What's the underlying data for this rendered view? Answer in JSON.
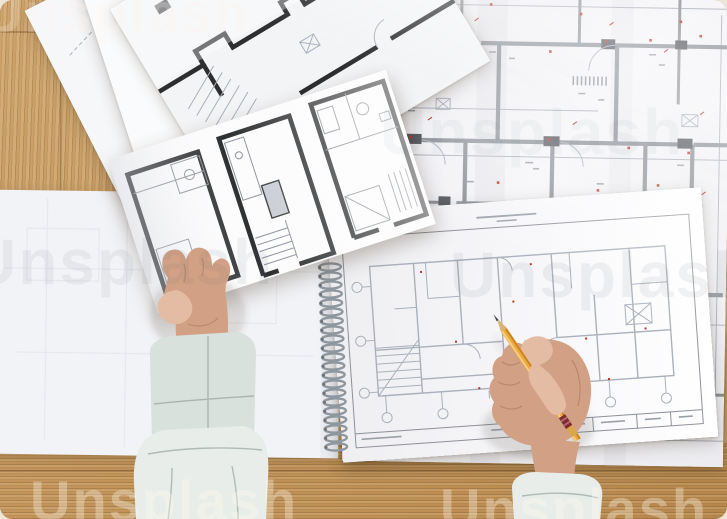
{
  "watermark": {
    "text": "Unsplash"
  },
  "palette": {
    "wood": "#c59b63",
    "wall": "#8b9097",
    "thin": "#aab0ba",
    "darkfill": "#53565c",
    "red": "#b5372e",
    "bold": "#2d2e30",
    "skin": "#d2a084",
    "sleeve": "#d9e1dd",
    "pencil": "#eaa93f",
    "pencil_band": "#7c2b33"
  },
  "scene": {
    "description": "Top-down photo of an architect's desk: hands hold a bold floor-plan sheet and a yellow pencil over a spiral-bound sketchpad, fanned plan sheets and a large annotated blueprint on a light oak table.",
    "objects": [
      "wooden desk",
      "large folded blueprint with red markings",
      "fanned floor-plan sheets",
      "held sheet with three bold apartment plans",
      "spiral-bound sketchpad with floor plan",
      "blank drawing pad",
      "left hand with pale cuff",
      "right hand holding yellow pencil"
    ]
  }
}
